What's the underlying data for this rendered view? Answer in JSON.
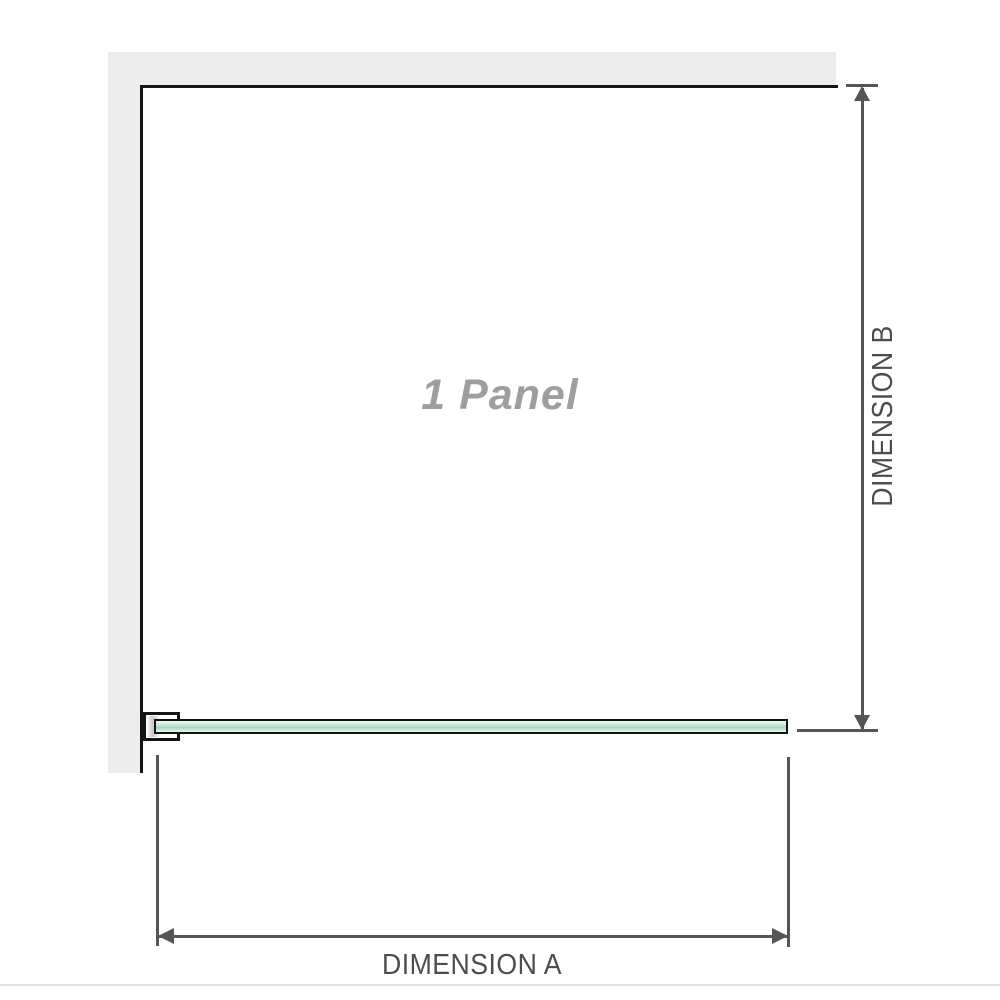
{
  "labels": {
    "panel": "1 Panel",
    "dimension_a": "DIMENSION A",
    "dimension_b": "DIMENSION B"
  },
  "colors": {
    "wall": "#ececec",
    "outline": "#141414",
    "dimension_lines": "#555555",
    "panel_label": "#9e9e9e",
    "glass_dark": "#a9d6bf",
    "divider": "#e0e0e0"
  }
}
